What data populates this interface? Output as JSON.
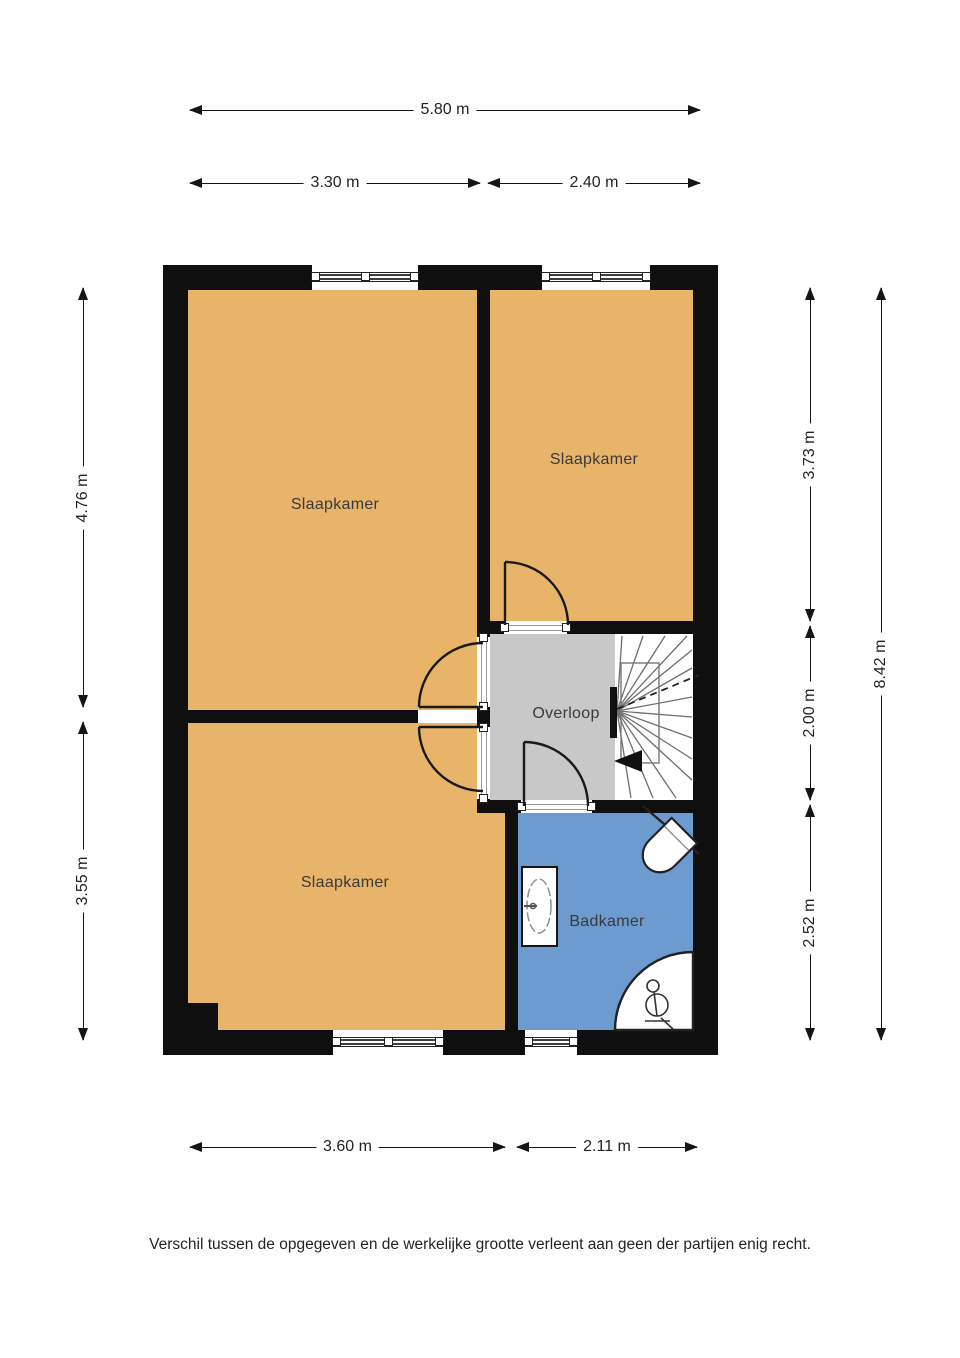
{
  "plan": {
    "floor_label": "",
    "rooms": {
      "slaapkamer1": {
        "label": "Slaapkamer"
      },
      "slaapkamer2": {
        "label": "Slaapkamer"
      },
      "slaapkamer3": {
        "label": "Slaapkamer"
      },
      "overloop": {
        "label": "Overloop"
      },
      "badkamer": {
        "label": "Badkamer"
      }
    },
    "fixtures": [
      "stairs",
      "sink",
      "toilet",
      "shower"
    ]
  },
  "dims": {
    "total_width": "5.80 m",
    "top_left": "3.30 m",
    "top_right": "2.40 m",
    "left_upper": "4.76 m",
    "left_lower": "3.55 m",
    "right_upper": "3.73 m",
    "right_middle": "2.00 m",
    "right_lower": "2.52 m",
    "total_height": "8.42 m",
    "bottom_left": "3.60 m",
    "bottom_right": "2.11 m"
  },
  "disclaimer": "Verschil tussen de opgegeven en de werkelijke grootte verleent aan geen der partijen enig recht.",
  "colors": {
    "bedroom_fill": "#e8b46a",
    "bathroom_fill": "#6d9bd0",
    "landing_fill": "#c8c8c8",
    "stairs_fill": "#ffffff",
    "wall": "#0f0f0f",
    "background": "#ffffff"
  }
}
